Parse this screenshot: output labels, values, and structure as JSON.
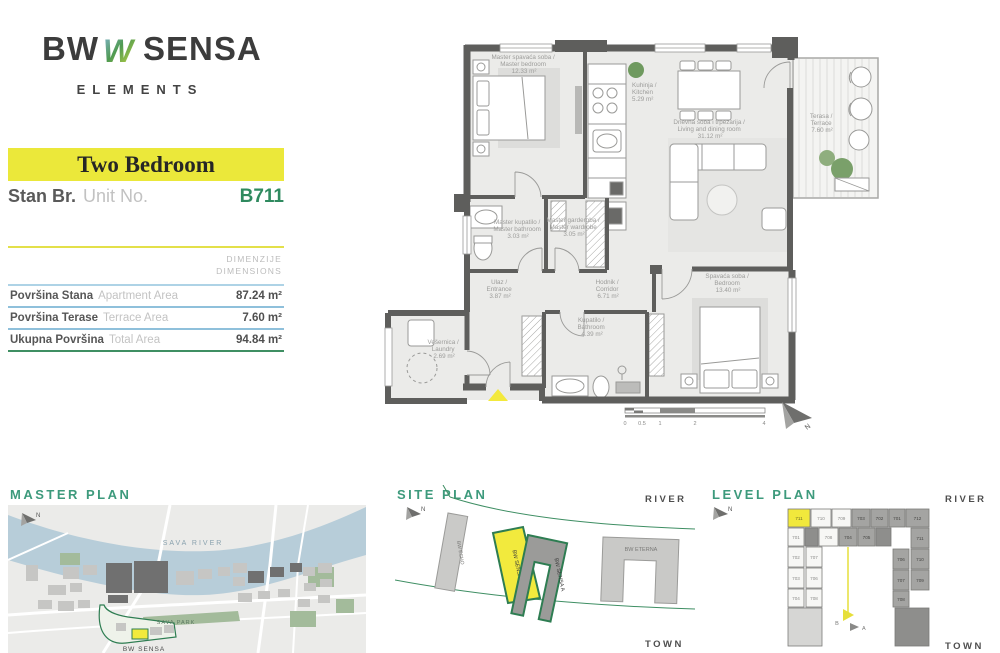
{
  "brand": {
    "bw": "BW",
    "sensa": "SENSA",
    "sub": "ELEMENTS"
  },
  "header": {
    "unit_type": "Two Bedroom",
    "stan_label": "Stan Br.",
    "unit_no_label": "Unit No.",
    "unit_number": "B711"
  },
  "dimensions": {
    "header_sr": "DIMENZIJE",
    "header_en": "DIMENSIONS",
    "rows": [
      {
        "label_sr": "Površina Stana",
        "label_en": "Apartment Area",
        "value": "87.24 m²"
      },
      {
        "label_sr": "Površina Terase",
        "label_en": "Terrace Area",
        "value": "7.60 m²"
      },
      {
        "label_sr": "Ukupna Površina",
        "label_en": "Total Area",
        "value": "94.84 m²"
      }
    ]
  },
  "floor_plan": {
    "rooms": [
      {
        "name_sr": "Master spavaća soba /",
        "name_en": "Master bedroom",
        "area": "12.33 m²"
      },
      {
        "name_sr": "Kuhinja /",
        "name_en": "Kitchen",
        "area": "5.29 m²"
      },
      {
        "name_sr": "Dnevna soba i trpezarija /",
        "name_en": "Living and dining room",
        "area": "31.12 m²"
      },
      {
        "name_sr": "Terasa /",
        "name_en": "Terrace",
        "area": "7.60 m²"
      },
      {
        "name_sr": "Master kupatilo /",
        "name_en": "Master bathroom",
        "area": "3.03 m²"
      },
      {
        "name_sr": "Master garderoba /",
        "name_en": "Master wardrobe",
        "area": "3.05 m²"
      },
      {
        "name_sr": "Hodnik /",
        "name_en": "Corridor",
        "area": "6.71 m²"
      },
      {
        "name_sr": "Spavaća soba /",
        "name_en": "Bedroom",
        "area": "13.40 m²"
      },
      {
        "name_sr": "Kupatilo /",
        "name_en": "Bathroom",
        "area": "4.39 m²"
      },
      {
        "name_sr": "Ulaz /",
        "name_en": "Entrance",
        "area": "3.87 m²"
      },
      {
        "name_sr": "Vešernica /",
        "name_en": "Laundry",
        "area": "2.69 m²"
      }
    ],
    "scale": [
      "0",
      "0.5",
      "1",
      "2",
      "4"
    ],
    "north": "N"
  },
  "master_plan": {
    "title": "MASTER PLAN",
    "river": "SAVA RIVER",
    "park": "SAVA PARK",
    "project": "BW SENSA",
    "north": "N"
  },
  "site_plan": {
    "title": "SITE PLAN",
    "river": "RIVER",
    "town": "TOWN",
    "north": "N",
    "buildings": {
      "echo": "BW ECHO",
      "sensa_b": "BW SENSA B",
      "sensa_a": "BW SENSA A",
      "eterna": "BW ETERNA"
    }
  },
  "level_plan": {
    "title": "LEVEL PLAN",
    "river": "RIVER",
    "town": "TOWN",
    "north": "N",
    "marker_a": "A",
    "marker_b": "B",
    "highlighted_unit": "711",
    "units": [
      {
        "label": "711",
        "x": 88,
        "y": 24,
        "w": 22,
        "h": 18,
        "tone": "y"
      },
      {
        "label": "710",
        "x": 111,
        "y": 24,
        "w": 20,
        "h": 18,
        "tone": "l"
      },
      {
        "label": "709",
        "x": 132,
        "y": 24,
        "w": 19,
        "h": 18,
        "tone": "l"
      },
      {
        "label": "703",
        "x": 152,
        "y": 24,
        "w": 18,
        "h": 18,
        "tone": "d"
      },
      {
        "label": "702",
        "x": 171,
        "y": 24,
        "w": 17,
        "h": 18,
        "tone": "d"
      },
      {
        "label": "701",
        "x": 189,
        "y": 24,
        "w": 16,
        "h": 18,
        "tone": "d"
      },
      {
        "label": "712",
        "x": 206,
        "y": 24,
        "w": 23,
        "h": 18,
        "tone": "d"
      },
      {
        "label": "701",
        "x": 88,
        "y": 43,
        "w": 16,
        "h": 18,
        "tone": "l"
      },
      {
        "label": "",
        "x": 105,
        "y": 43,
        "w": 13,
        "h": 18,
        "tone": "dc"
      },
      {
        "label": "708",
        "x": 119,
        "y": 43,
        "w": 19,
        "h": 18,
        "tone": "l"
      },
      {
        "label": "704",
        "x": 139,
        "y": 43,
        "w": 18,
        "h": 18,
        "tone": "d"
      },
      {
        "label": "705",
        "x": 158,
        "y": 43,
        "w": 17,
        "h": 18,
        "tone": "d"
      },
      {
        "label": "",
        "x": 176,
        "y": 43,
        "w": 15,
        "h": 18,
        "tone": "dc"
      },
      {
        "label": "711",
        "x": 211,
        "y": 43,
        "w": 18,
        "h": 20,
        "tone": "d"
      },
      {
        "label": "702",
        "x": 88,
        "y": 62,
        "w": 16,
        "h": 20,
        "tone": "l"
      },
      {
        "label": "707",
        "x": 106,
        "y": 62,
        "w": 16,
        "h": 20,
        "tone": "l"
      },
      {
        "label": "703",
        "x": 88,
        "y": 83,
        "w": 16,
        "h": 20,
        "tone": "l"
      },
      {
        "label": "706",
        "x": 106,
        "y": 83,
        "w": 16,
        "h": 20,
        "tone": "l"
      },
      {
        "label": "704",
        "x": 88,
        "y": 104,
        "w": 16,
        "h": 18,
        "tone": "l"
      },
      {
        "label": "708",
        "x": 106,
        "y": 104,
        "w": 16,
        "h": 18,
        "tone": "l"
      },
      {
        "label": "706",
        "x": 193,
        "y": 64,
        "w": 16,
        "h": 20,
        "tone": "d"
      },
      {
        "label": "710",
        "x": 211,
        "y": 64,
        "w": 18,
        "h": 20,
        "tone": "d"
      },
      {
        "label": "707",
        "x": 193,
        "y": 85,
        "w": 16,
        "h": 20,
        "tone": "d"
      },
      {
        "label": "709",
        "x": 211,
        "y": 85,
        "w": 18,
        "h": 20,
        "tone": "d"
      },
      {
        "label": "708",
        "x": 193,
        "y": 106,
        "w": 16,
        "h": 16,
        "tone": "d"
      },
      {
        "label": "",
        "x": 88,
        "y": 123,
        "w": 34,
        "h": 38,
        "tone": "lc"
      },
      {
        "label": "",
        "x": 195,
        "y": 123,
        "w": 34,
        "h": 38,
        "tone": "dc"
      }
    ]
  }
}
